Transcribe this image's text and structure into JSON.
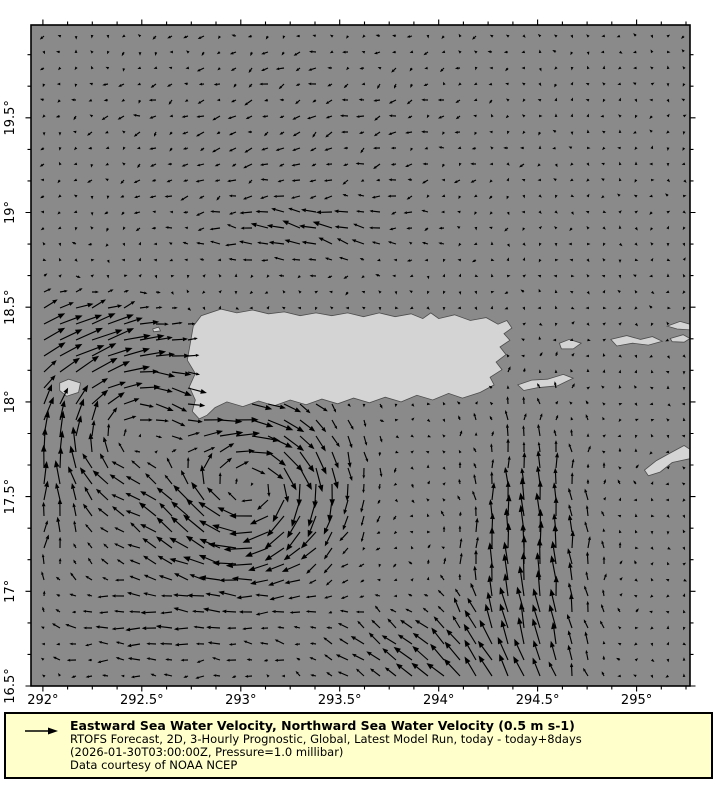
{
  "chart_data": {
    "type": "quiver-map",
    "description": "Vector field of ocean surface currents around Puerto Rico and the Virgin Islands",
    "colors": {
      "ocean": "#8a8a8a",
      "land": "#d4d4d4",
      "land_edge": "#4d4d4d",
      "arrows": "#000000",
      "frame": "#000000",
      "figure_bg": "#ffffff"
    },
    "axes": {
      "lon_min": 291.94,
      "lon_max": 295.27,
      "lat_min": 16.5,
      "lat_max": 19.99,
      "x_major_ticks": [
        292,
        292.5,
        293,
        293.5,
        294,
        294.5,
        295
      ],
      "x_major_labels": [
        "292°",
        "292.5°",
        "293°",
        "293.5°",
        "294°",
        "294.5°",
        "295°"
      ],
      "x_minor_step": 0.125,
      "y_major_ticks": [
        16.5,
        17,
        17.5,
        18,
        18.5,
        19,
        19.5
      ],
      "y_major_labels": [
        "16.5°",
        "17°",
        "17.5°",
        "18°",
        "18.5°",
        "19°",
        "19.5°"
      ],
      "y_minor_step": 0.1666667
    },
    "reference_vector": {
      "value": 0.5,
      "units": "m s-1"
    },
    "quiver_grid": {
      "x0": 44,
      "y0": 36,
      "step": 16,
      "nx": 41,
      "ny": 41,
      "px_per_ms": 56,
      "noise_ms": 0.055
    },
    "flow_features": [
      {
        "type": "jet",
        "name": "mona-passage-eastward-jet",
        "lon": 292.2,
        "lat": 18.35,
        "sx": 0.45,
        "sy": 0.22,
        "u": 0.4,
        "v": 0.14
      },
      {
        "type": "vortex",
        "name": "south-coast-anticyclonic-eddy",
        "lon": 293.05,
        "lat": 17.55,
        "radius": 0.4,
        "strength": -0.75
      },
      {
        "type": "vortex",
        "name": "mona-anticyclonic-eddy",
        "lon": 292.42,
        "lat": 17.82,
        "radius": 0.38,
        "strength": -0.45
      },
      {
        "type": "jet",
        "name": "east-northward-jet",
        "lon": 294.45,
        "lat": 17.1,
        "sx": 0.32,
        "sy": 0.75,
        "u": -0.03,
        "v": 0.48
      },
      {
        "type": "jet",
        "name": "south-central-northwest-flow",
        "lon": 293.95,
        "lat": 16.62,
        "sx": 0.55,
        "sy": 0.28,
        "u": -0.28,
        "v": 0.22
      },
      {
        "type": "jet",
        "name": "west-boundary-northward-flow",
        "lon": 291.95,
        "lat": 17.55,
        "sx": 0.28,
        "sy": 0.6,
        "u": 0.12,
        "v": 0.26
      },
      {
        "type": "jet",
        "name": "north-westward-streak",
        "lon": 293.35,
        "lat": 18.9,
        "sx": 0.42,
        "sy": 0.16,
        "u": -0.26,
        "v": 0.12
      },
      {
        "type": "jet",
        "name": "southwest-westward-drift",
        "lon": 292.55,
        "lat": 16.8,
        "sx": 0.65,
        "sy": 0.3,
        "u": -0.22,
        "v": 0.0
      },
      {
        "type": "jet",
        "name": "north-westward-drift",
        "lon": 293.2,
        "lat": 19.4,
        "sx": 1.1,
        "sy": 0.7,
        "u": -0.12,
        "v": -0.05
      }
    ],
    "islands": [
      {
        "name": "puerto-rico",
        "coords": [
          [
            292.75,
            18.34
          ],
          [
            292.76,
            18.4
          ],
          [
            292.8,
            18.455
          ],
          [
            292.9,
            18.49
          ],
          [
            292.98,
            18.47
          ],
          [
            293.06,
            18.485
          ],
          [
            293.14,
            18.465
          ],
          [
            293.22,
            18.475
          ],
          [
            293.3,
            18.455
          ],
          [
            293.38,
            18.47
          ],
          [
            293.46,
            18.455
          ],
          [
            293.54,
            18.47
          ],
          [
            293.62,
            18.45
          ],
          [
            293.7,
            18.47
          ],
          [
            293.78,
            18.45
          ],
          [
            293.86,
            18.465
          ],
          [
            293.92,
            18.44
          ],
          [
            293.96,
            18.47
          ],
          [
            294.0,
            18.44
          ],
          [
            294.08,
            18.46
          ],
          [
            294.16,
            18.43
          ],
          [
            294.24,
            18.445
          ],
          [
            294.3,
            18.41
          ],
          [
            294.345,
            18.43
          ],
          [
            294.37,
            18.39
          ],
          [
            294.33,
            18.36
          ],
          [
            294.36,
            18.325
          ],
          [
            294.31,
            18.29
          ],
          [
            294.34,
            18.25
          ],
          [
            294.29,
            18.21
          ],
          [
            294.32,
            18.17
          ],
          [
            294.26,
            18.13
          ],
          [
            294.28,
            18.09
          ],
          [
            294.21,
            18.05
          ],
          [
            294.12,
            18.02
          ],
          [
            294.05,
            18.045
          ],
          [
            293.97,
            18.01
          ],
          [
            293.89,
            18.035
          ],
          [
            293.81,
            18.0
          ],
          [
            293.73,
            18.025
          ],
          [
            293.65,
            17.995
          ],
          [
            293.57,
            18.02
          ],
          [
            293.49,
            17.99
          ],
          [
            293.41,
            18.015
          ],
          [
            293.33,
            17.985
          ],
          [
            293.25,
            18.01
          ],
          [
            293.17,
            17.98
          ],
          [
            293.09,
            18.005
          ],
          [
            293.01,
            17.975
          ],
          [
            292.93,
            18.0
          ],
          [
            292.87,
            17.97
          ],
          [
            292.83,
            17.93
          ],
          [
            292.79,
            17.91
          ],
          [
            292.755,
            17.95
          ],
          [
            292.77,
            18.01
          ],
          [
            292.74,
            18.08
          ],
          [
            292.77,
            18.15
          ],
          [
            292.73,
            18.22
          ],
          [
            292.74,
            18.28
          ],
          [
            292.75,
            18.34
          ]
        ]
      },
      {
        "name": "vieques",
        "coords": [
          [
            294.4,
            18.09
          ],
          [
            294.47,
            18.115
          ],
          [
            294.55,
            18.12
          ],
          [
            294.63,
            18.145
          ],
          [
            294.68,
            18.125
          ],
          [
            294.6,
            18.085
          ],
          [
            294.5,
            18.075
          ],
          [
            294.43,
            18.06
          ],
          [
            294.4,
            18.09
          ]
        ]
      },
      {
        "name": "culebra",
        "coords": [
          [
            294.61,
            18.31
          ],
          [
            294.66,
            18.33
          ],
          [
            294.72,
            18.31
          ],
          [
            294.68,
            18.28
          ],
          [
            294.62,
            18.28
          ],
          [
            294.61,
            18.31
          ]
        ]
      },
      {
        "name": "st-thomas-st-john",
        "coords": [
          [
            294.87,
            18.33
          ],
          [
            294.95,
            18.35
          ],
          [
            295.02,
            18.33
          ],
          [
            295.08,
            18.345
          ],
          [
            295.13,
            18.32
          ],
          [
            295.06,
            18.3
          ],
          [
            294.98,
            18.31
          ],
          [
            294.9,
            18.295
          ],
          [
            294.87,
            18.33
          ]
        ]
      },
      {
        "name": "tortola",
        "coords": [
          [
            295.155,
            18.4
          ],
          [
            295.22,
            18.425
          ],
          [
            295.27,
            18.41
          ],
          [
            295.27,
            18.38
          ],
          [
            295.205,
            18.385
          ],
          [
            295.155,
            18.4
          ]
        ]
      },
      {
        "name": "virgin-gorda",
        "coords": [
          [
            295.17,
            18.335
          ],
          [
            295.235,
            18.355
          ],
          [
            295.27,
            18.335
          ],
          [
            295.24,
            18.315
          ],
          [
            295.18,
            18.318
          ],
          [
            295.17,
            18.335
          ]
        ]
      },
      {
        "name": "st-croix",
        "coords": [
          [
            295.04,
            17.64
          ],
          [
            295.1,
            17.69
          ],
          [
            295.17,
            17.73
          ],
          [
            295.24,
            17.77
          ],
          [
            295.27,
            17.75
          ],
          [
            295.27,
            17.7
          ],
          [
            295.18,
            17.68
          ],
          [
            295.12,
            17.63
          ],
          [
            295.06,
            17.61
          ],
          [
            295.04,
            17.64
          ]
        ]
      },
      {
        "name": "mona",
        "coords": [
          [
            292.085,
            18.1
          ],
          [
            292.13,
            18.12
          ],
          [
            292.19,
            18.1
          ],
          [
            292.18,
            18.05
          ],
          [
            292.12,
            18.03
          ],
          [
            292.085,
            18.06
          ],
          [
            292.085,
            18.1
          ]
        ]
      },
      {
        "name": "desecheo",
        "coords": [
          [
            292.555,
            18.385
          ],
          [
            292.585,
            18.395
          ],
          [
            292.595,
            18.375
          ],
          [
            292.56,
            18.37
          ],
          [
            292.555,
            18.385
          ]
        ]
      }
    ],
    "legend": {
      "bg_color": "#ffffcc",
      "border_color": "#000000",
      "title": "Eastward Sea Water Velocity, Northward Sea Water Velocity (0.5 m s-1)",
      "line2": "RTOFS Forecast, 2D, 3-Hourly Prognostic, Global, Latest Model Run, today - today+8days",
      "line3": "(2026-01-30T03:00:00Z, Pressure=1.0 millibar)",
      "line4": "Data courtesy of NOAA NCEP"
    }
  }
}
